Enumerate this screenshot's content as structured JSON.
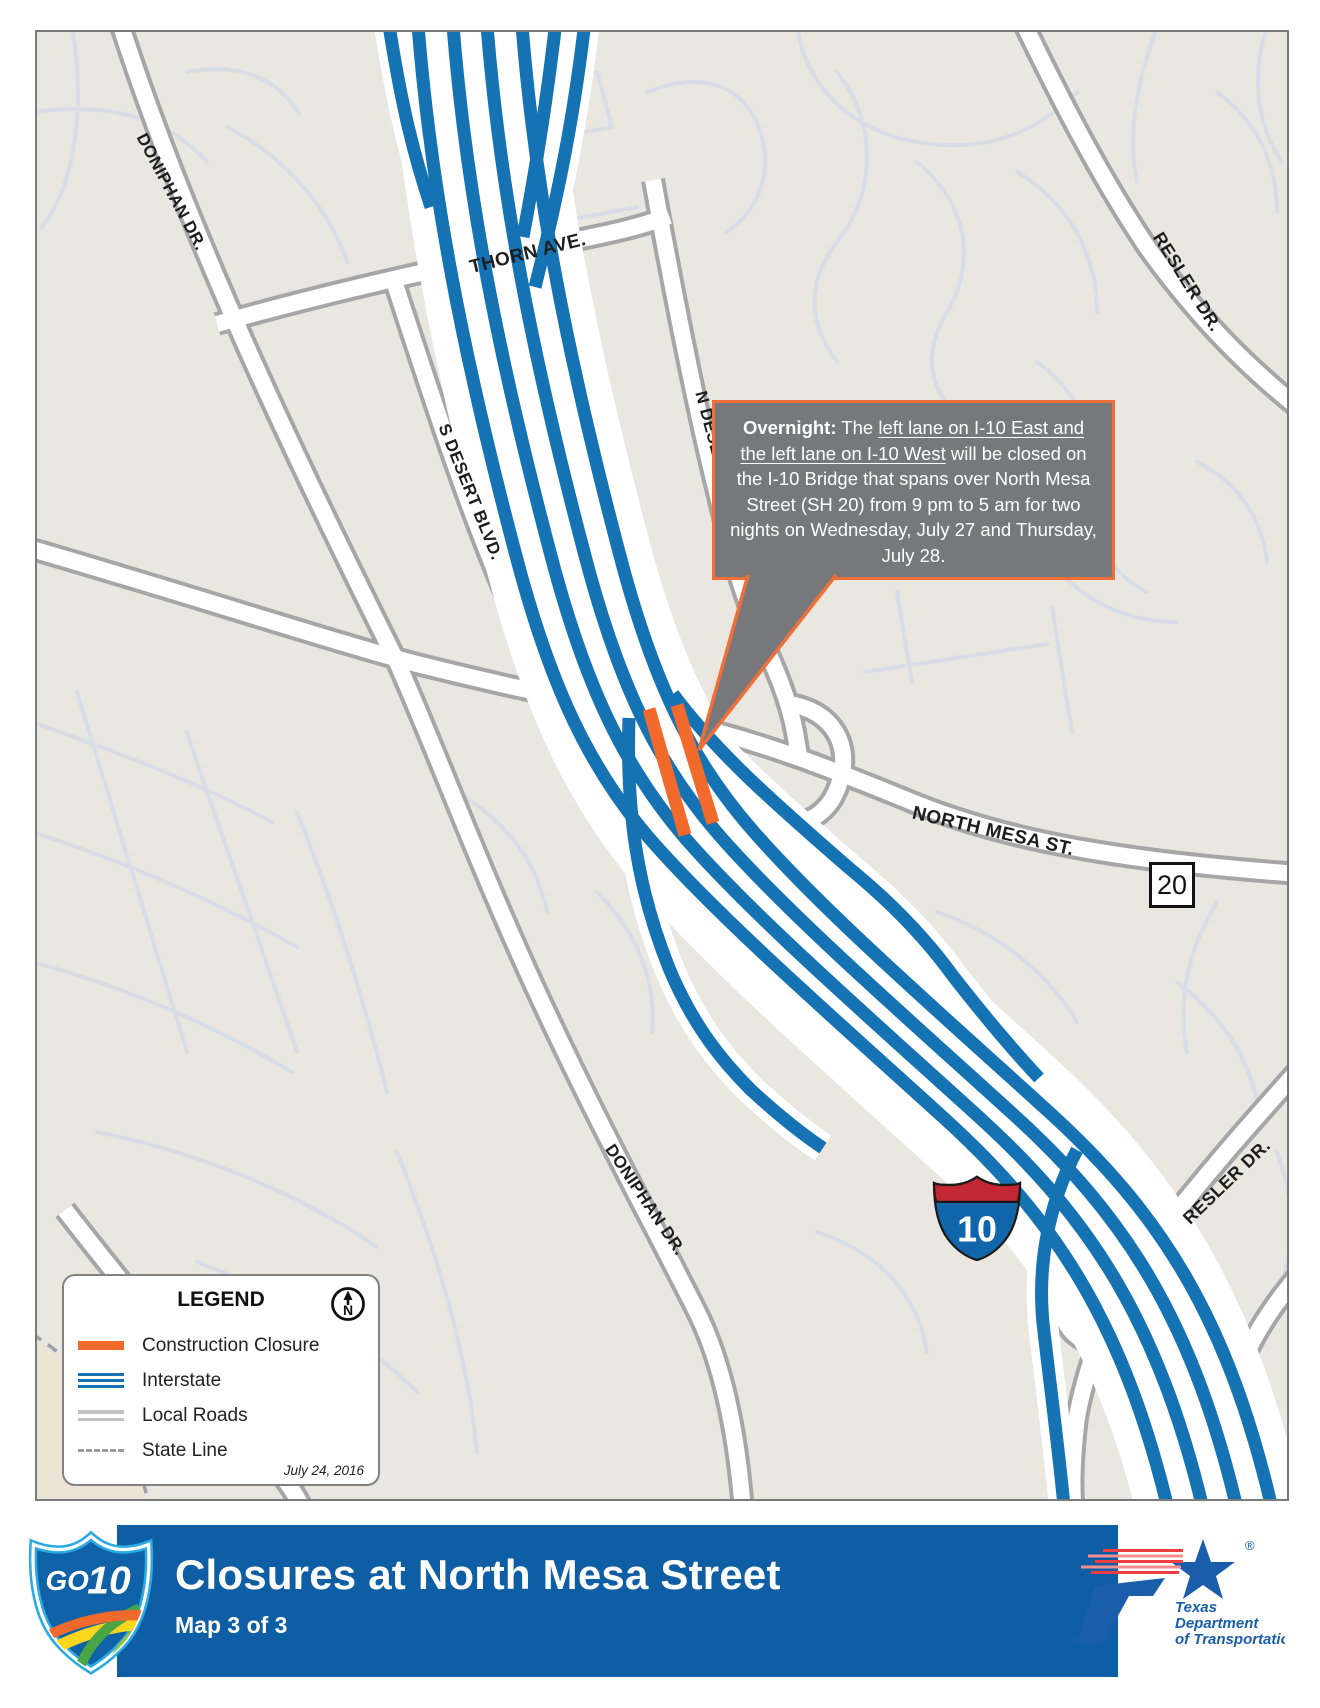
{
  "map": {
    "labels": {
      "doniphan_top": "DONIPHAN DR.",
      "thorn": "THORN AVE.",
      "s_desert": "S DESERT BLVD.",
      "n_desert": "N DESERT BLVD.",
      "resler_top": "RESLER DR.",
      "north_mesa": "NORTH MESA ST.",
      "doniphan_bottom": "DONIPHAN DR.",
      "resler_bottom": "RESLER DR."
    },
    "shields": {
      "sh20": "20",
      "i10": "10"
    }
  },
  "callout": {
    "lead": "Overnight:",
    "seg_pre": " The ",
    "underlined": "left lane on I-10 East and the left lane on I-10 West",
    "seg_post": " will be closed on the I-10 Bridge that spans over North Mesa Street (SH 20) from 9 pm to 5 am for two nights on Wednesday, July 27 and Thursday, July 28."
  },
  "legend": {
    "title": "LEGEND",
    "north": "N",
    "items": [
      {
        "label": "Construction Closure",
        "type": "closure"
      },
      {
        "label": "Interstate",
        "type": "interstate"
      },
      {
        "label": "Local Roads",
        "type": "local"
      },
      {
        "label": "State Line",
        "type": "stateline"
      }
    ],
    "date": "July 24, 2016"
  },
  "banner": {
    "title": "Closures at North Mesa Street",
    "subtitle": "Map 3 of 3",
    "go_logo": {
      "go": "GO",
      "ten": "10"
    },
    "txdot": {
      "line1": "Texas",
      "line2": "Department",
      "line3": "of Transportation",
      "reg": "®"
    }
  },
  "colors": {
    "interstate_blue": "#1573b4",
    "closure_orange": "#f2692c",
    "callout_gray": "#77787b",
    "banner_blue": "#0e5ea6"
  }
}
